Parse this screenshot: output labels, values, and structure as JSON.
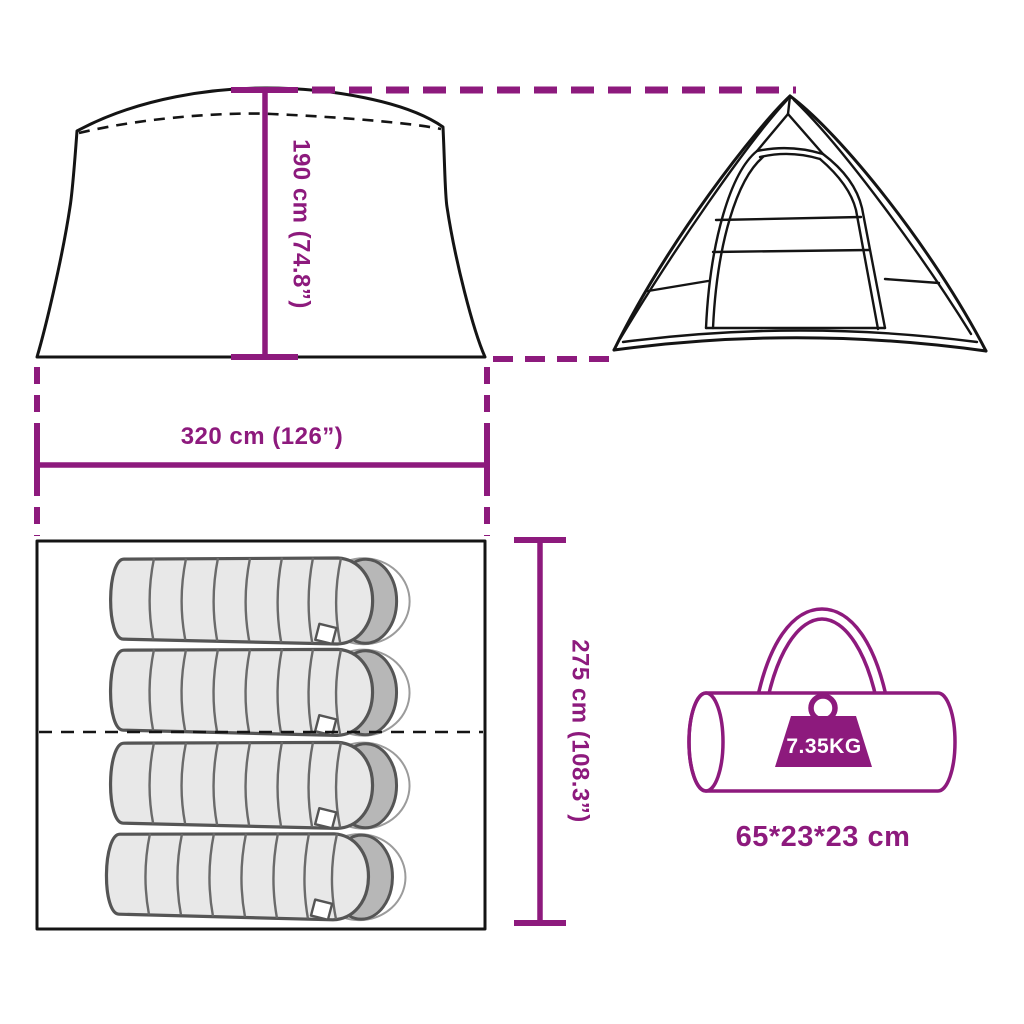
{
  "labels": {
    "height": "190 cm (74.8”)",
    "width": "320 cm (126”)",
    "depth": "275 cm (108.3”)",
    "weight": "7.35KG",
    "bag_size": "65*23*23 cm"
  },
  "colors": {
    "accent": "#8d1a7d",
    "line": "#141414",
    "bag_fill": "#e8e8e8",
    "bag_head": "#b7b7b7",
    "bag_outline": "#555555",
    "background": "#ffffff"
  },
  "icons": {
    "weight": "weight-icon"
  }
}
